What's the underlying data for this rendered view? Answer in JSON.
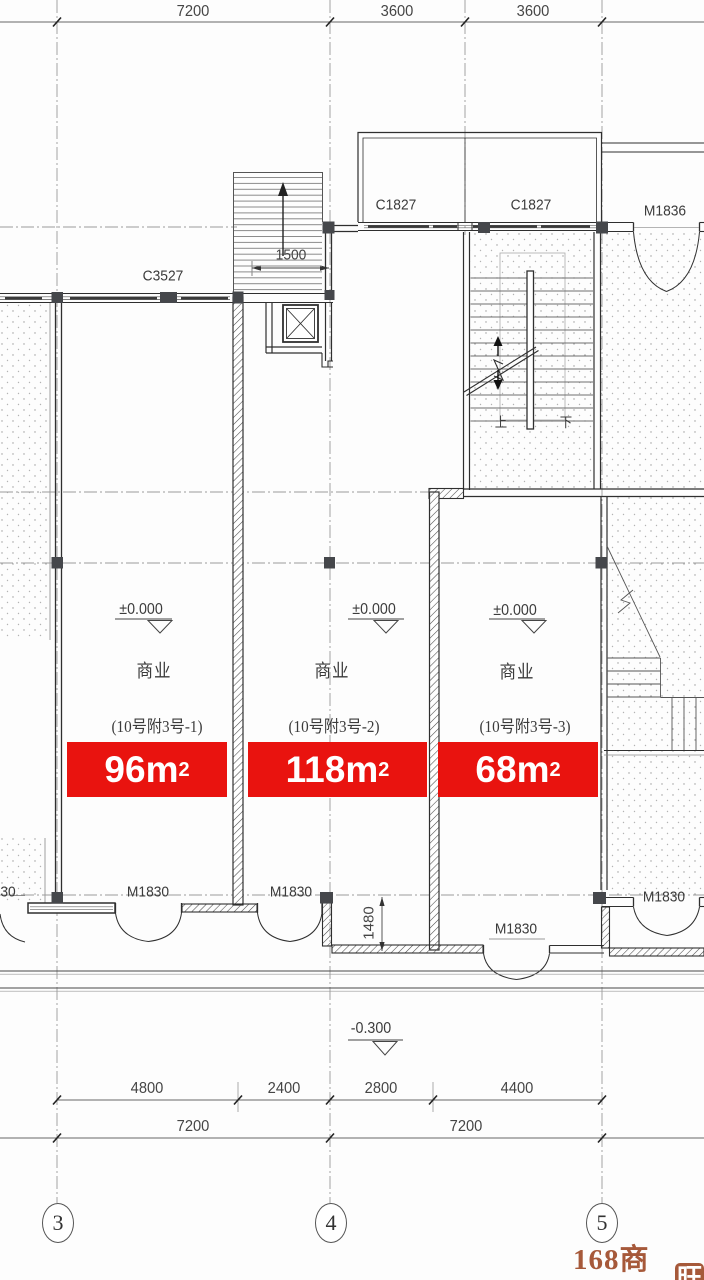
{
  "drawing": {
    "top_dimensions": [
      "7200",
      "3600",
      "3600"
    ],
    "bottom_dimensions_row1": [
      "4800",
      "2400",
      "2800",
      "4400"
    ],
    "bottom_dimensions_row2": [
      "7200",
      "7200"
    ],
    "grid_bubbles": [
      "3",
      "4",
      "5"
    ],
    "annotations": {
      "stair_width_dim": "1500",
      "recess_depth_dim": "1480",
      "level_street": "-0.300",
      "stair_up": "上",
      "stair_down": "下"
    },
    "openings": {
      "window_c3527": "C3527",
      "window_c1827_left": "C1827",
      "window_c1827_right": "C1827",
      "door_m1836": "M1836",
      "door_m1830_unit1": "M1830",
      "door_m1830_unit2": "M1830",
      "door_m1830_recessed": "M1830",
      "door_m1830_right": "M1830",
      "door_m1830_partial": "30"
    },
    "units": [
      {
        "level": "±0.000",
        "use": "商业",
        "number": "(10号附3号-1)",
        "area_value": "96",
        "area_unit": "m",
        "area_exponent": "2"
      },
      {
        "level": "±0.000",
        "use": "商业",
        "number": "(10号附3号-2)",
        "area_value": "118",
        "area_unit": "m",
        "area_exponent": "2"
      },
      {
        "level": "±0.000",
        "use": "商业",
        "number": "(10号附3号-3)",
        "area_value": "68",
        "area_unit": "m",
        "area_exponent": "2"
      }
    ],
    "watermark": {
      "brand": "168商铺",
      "badge": "旺"
    },
    "colors": {
      "banner_red": "#e9130f",
      "watermark_brown": "#a6593a",
      "line_dark": "#3b3b3b"
    }
  }
}
